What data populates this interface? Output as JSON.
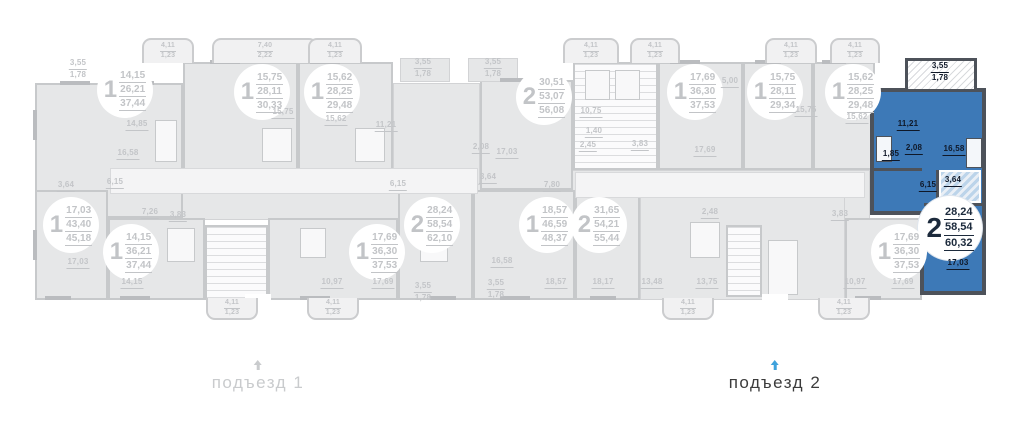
{
  "colors": {
    "highlight_fill": "#3d79b7",
    "highlight_wall": "#4d525a",
    "muted_grey": "#c9cbcd",
    "active_text": "#3c3c3c",
    "active_arrow": "#3fa2dc"
  },
  "entrance_1": {
    "label": "подъезд 1"
  },
  "entrance_2": {
    "label": "подъезд 2"
  },
  "plan": {
    "badges": [
      {
        "num": "1",
        "v": [
          "14,15",
          "26,21",
          "37,44"
        ],
        "x": 125,
        "y": 90
      },
      {
        "num": "1",
        "v": [
          "15,75",
          "28,11",
          "30,33"
        ],
        "x": 262,
        "y": 92
      },
      {
        "num": "1",
        "v": [
          "15,62",
          "28,25",
          "29,48"
        ],
        "x": 332,
        "y": 92
      },
      {
        "num": "2",
        "v": [
          "30,51",
          "53,07",
          "56,08"
        ],
        "x": 544,
        "y": 97
      },
      {
        "num": "1",
        "v": [
          "17,69",
          "36,30",
          "37,53"
        ],
        "x": 695,
        "y": 92
      },
      {
        "num": "1",
        "v": [
          "15,75",
          "28,11",
          "29,34"
        ],
        "x": 775,
        "y": 92
      },
      {
        "num": "1",
        "v": [
          "15,62",
          "28,25",
          "29,48"
        ],
        "x": 853,
        "y": 92
      },
      {
        "num": "2",
        "v": [
          "28,24",
          "58,54",
          "60,32"
        ],
        "x": 950,
        "y": 228,
        "hl": true
      },
      {
        "num": "1",
        "v": [
          "17,03",
          "43,40",
          "45,18"
        ],
        "x": 71,
        "y": 225
      },
      {
        "num": "1",
        "v": [
          "14,15",
          "36,21",
          "37,44"
        ],
        "x": 131,
        "y": 252
      },
      {
        "num": "1",
        "v": [
          "17,69",
          "36,30",
          "37,53"
        ],
        "x": 377,
        "y": 252
      },
      {
        "num": "2",
        "v": [
          "28,24",
          "58,54",
          "62,10"
        ],
        "x": 432,
        "y": 225
      },
      {
        "num": "1",
        "v": [
          "18,57",
          "46,59",
          "48,37"
        ],
        "x": 547,
        "y": 225
      },
      {
        "num": "2",
        "v": [
          "31,65",
          "54,21",
          "55,44"
        ],
        "x": 599,
        "y": 225
      },
      {
        "num": "1",
        "v": [
          "17,69",
          "36,30",
          "37,53"
        ],
        "x": 899,
        "y": 252
      }
    ],
    "labels": [
      {
        "t": "3,55",
        "t2": "1,78",
        "x": 78,
        "y": 69
      },
      {
        "t": "14,85",
        "x": 137,
        "y": 125
      },
      {
        "t": "16,58",
        "x": 128,
        "y": 154
      },
      {
        "t": "3,64",
        "x": 66,
        "y": 186
      },
      {
        "t": "6,15",
        "x": 115,
        "y": 183
      },
      {
        "t": "7,26",
        "x": 150,
        "y": 213
      },
      {
        "t": "3,83",
        "x": 178,
        "y": 216
      },
      {
        "t": "15,75",
        "x": 283,
        "y": 113
      },
      {
        "t": "15,62",
        "x": 336,
        "y": 120
      },
      {
        "t": "11,21",
        "x": 386,
        "y": 126
      },
      {
        "t": "2,08",
        "x": 481,
        "y": 148
      },
      {
        "t": "17,03",
        "x": 507,
        "y": 153
      },
      {
        "t": "3,64",
        "x": 488,
        "y": 178
      },
      {
        "t": "6,15",
        "x": 398,
        "y": 185
      },
      {
        "t": "3,55",
        "t2": "1,78",
        "x": 423,
        "y": 68
      },
      {
        "t": "3,55",
        "t2": "1,78",
        "x": 493,
        "y": 68
      },
      {
        "t": "10,75",
        "x": 591,
        "y": 112
      },
      {
        "t": "1,40",
        "x": 594,
        "y": 132
      },
      {
        "t": "2,45",
        "x": 588,
        "y": 146
      },
      {
        "t": "3,83",
        "x": 640,
        "y": 145
      },
      {
        "t": "5,00",
        "x": 730,
        "y": 82
      },
      {
        "t": "17,69",
        "x": 705,
        "y": 151
      },
      {
        "t": "15,75",
        "x": 806,
        "y": 111
      },
      {
        "t": "15,62",
        "x": 857,
        "y": 118
      },
      {
        "t": "2,48",
        "x": 710,
        "y": 213
      },
      {
        "t": "3,83",
        "x": 840,
        "y": 215
      },
      {
        "t": "17,03",
        "x": 78,
        "y": 263
      },
      {
        "t": "14,15",
        "x": 132,
        "y": 283
      },
      {
        "t": "10,97",
        "x": 332,
        "y": 283
      },
      {
        "t": "17,69",
        "x": 383,
        "y": 283
      },
      {
        "t": "7,80",
        "x": 552,
        "y": 186
      },
      {
        "t": "16,58",
        "x": 502,
        "y": 262
      },
      {
        "t": "18,57",
        "x": 556,
        "y": 283
      },
      {
        "t": "18,17",
        "x": 603,
        "y": 283
      },
      {
        "t": "13,48",
        "x": 652,
        "y": 283
      },
      {
        "t": "13,75",
        "x": 707,
        "y": 283
      },
      {
        "t": "10,97",
        "x": 855,
        "y": 283
      },
      {
        "t": "17,69",
        "x": 903,
        "y": 283
      },
      {
        "t": "3,55",
        "t2": "1,78",
        "x": 423,
        "y": 292
      },
      {
        "t": "3,55",
        "t2": "1,78",
        "x": 496,
        "y": 289
      },
      {
        "t": "3,55",
        "t2": "1,78",
        "x": 940,
        "y": 72,
        "blue": true
      },
      {
        "t": "11,21",
        "x": 908,
        "y": 125,
        "blue": true
      },
      {
        "t": "1,85",
        "x": 891,
        "y": 155,
        "blue": true
      },
      {
        "t": "2,08",
        "x": 914,
        "y": 149,
        "blue": true
      },
      {
        "t": "16,58",
        "x": 954,
        "y": 150,
        "blue": true
      },
      {
        "t": "6,15",
        "x": 928,
        "y": 186,
        "blue": true
      },
      {
        "t": "3,64",
        "x": 953,
        "y": 181,
        "blue": true
      },
      {
        "t": "17,03",
        "x": 958,
        "y": 264,
        "blue": true
      }
    ],
    "balconies": [
      {
        "x": 168,
        "w": 52,
        "lines": [
          "4,11",
          "1,23"
        ]
      },
      {
        "x": 265,
        "w": 106,
        "lines": [
          "7,40",
          "2,22"
        ]
      },
      {
        "x": 335,
        "w": 54,
        "lines": [
          "4,11",
          "1,23"
        ]
      },
      {
        "x": 591,
        "w": 56,
        "lines": [
          "4,11",
          "1,23"
        ]
      },
      {
        "x": 655,
        "w": 50,
        "lines": [
          "4,11",
          "1,23"
        ]
      },
      {
        "x": 791,
        "w": 52,
        "lines": [
          "4,11",
          "1,23"
        ]
      },
      {
        "x": 855,
        "w": 50,
        "lines": [
          "4,11",
          "1,23"
        ]
      },
      {
        "x": 232,
        "w": 52,
        "lines": [
          "4,11",
          "1,23"
        ],
        "down": true
      },
      {
        "x": 333,
        "w": 52,
        "lines": [
          "4,11",
          "1,23"
        ],
        "down": true
      },
      {
        "x": 688,
        "w": 52,
        "lines": [
          "4,11",
          "1,23"
        ],
        "down": true
      },
      {
        "x": 844,
        "w": 52,
        "lines": [
          "4,11",
          "1,23"
        ],
        "down": true
      }
    ]
  }
}
